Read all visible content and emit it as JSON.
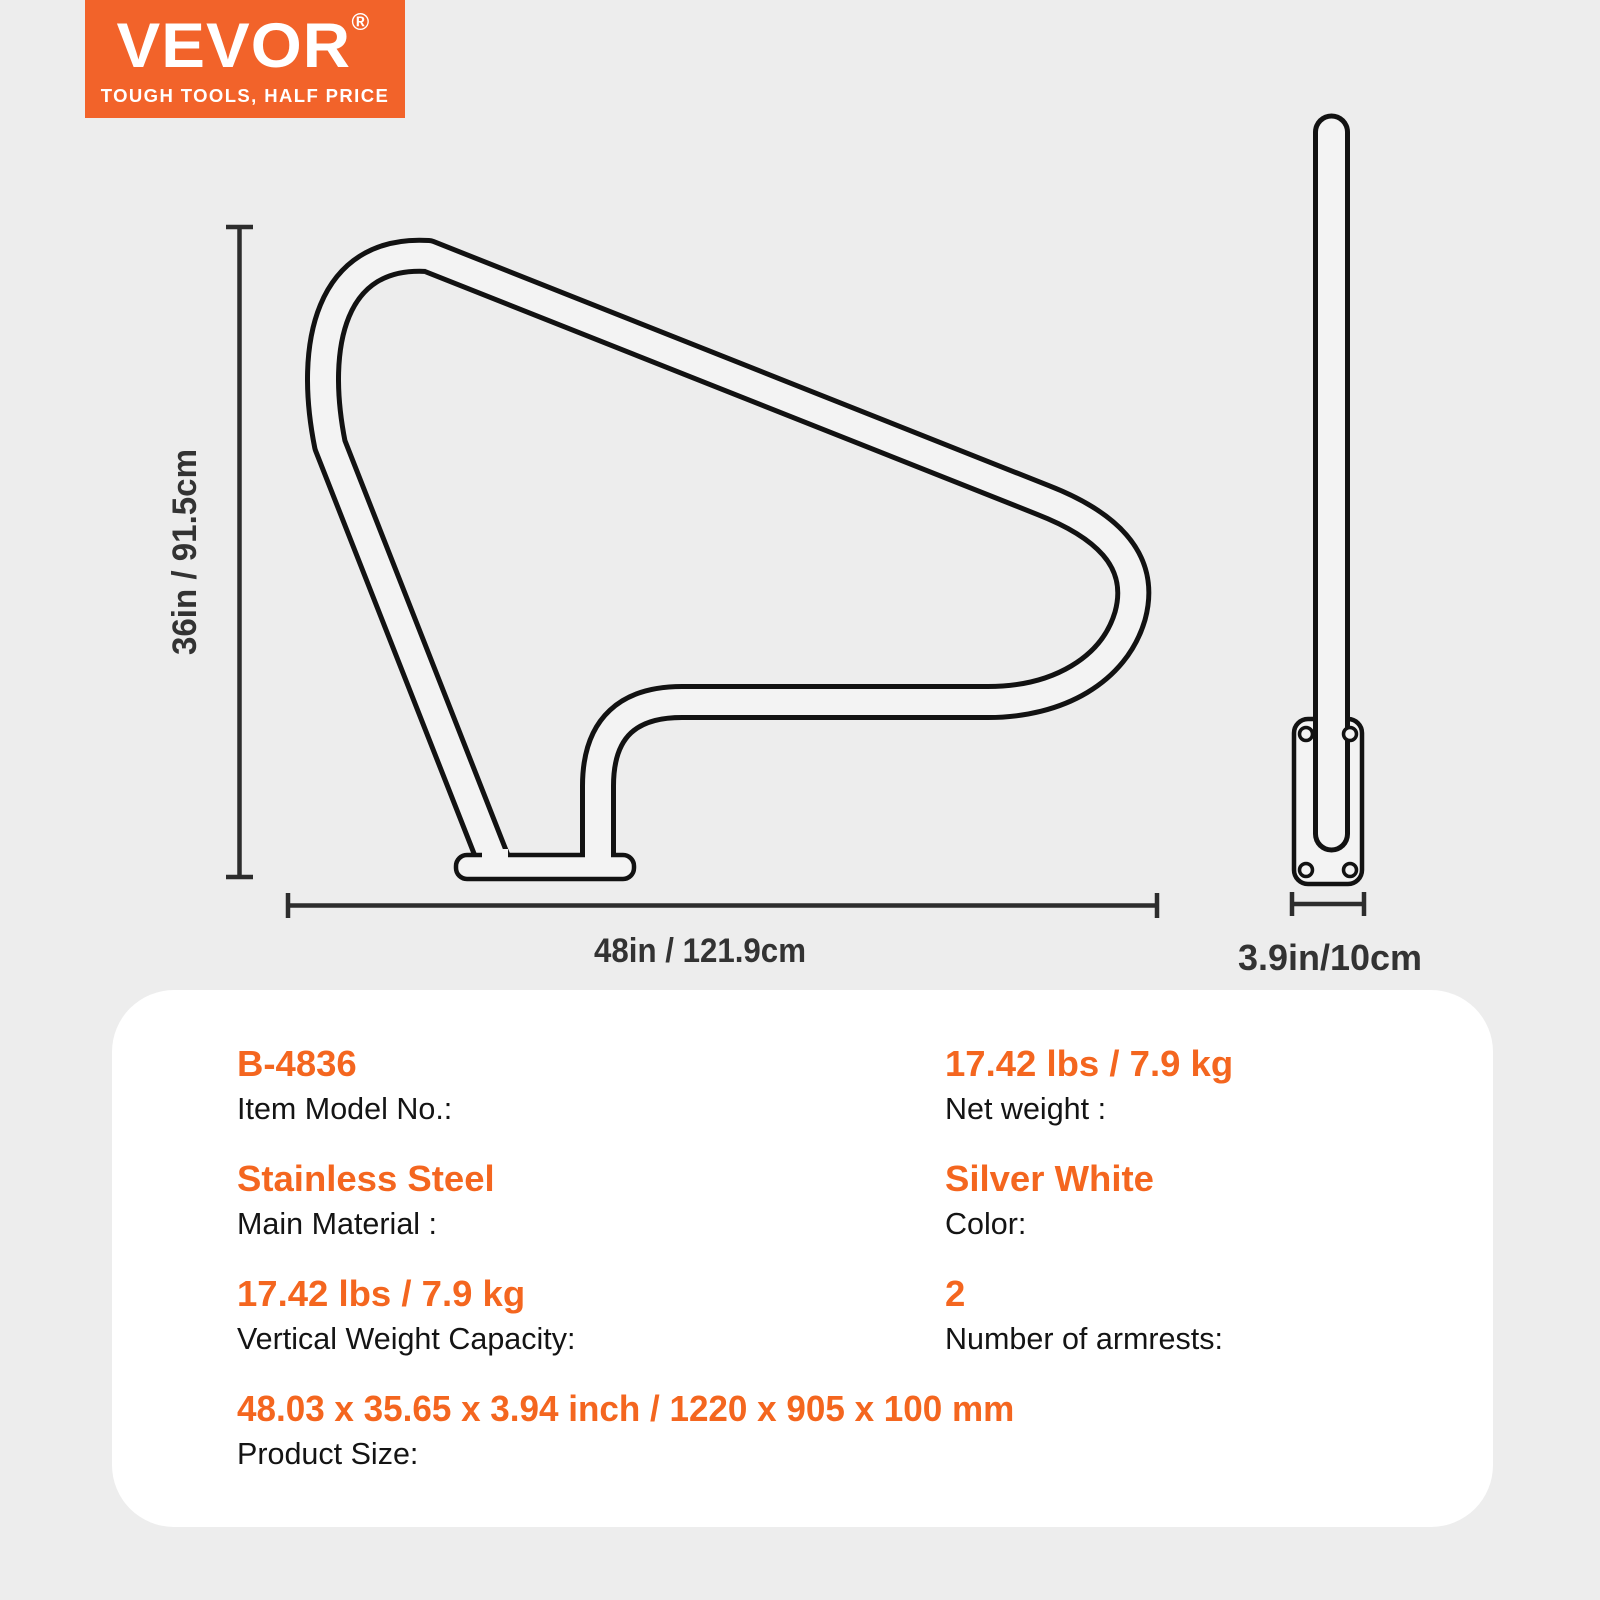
{
  "logo": {
    "brand": "VEVOR",
    "registered": "®",
    "tagline": "TOUGH TOOLS, HALF PRICE"
  },
  "diagram": {
    "height_label": "36in / 91.5cm",
    "width_label": "48in / 121.9cm",
    "depth_label": "3.9in/10cm"
  },
  "specs": {
    "rows": [
      {
        "value": "B-4836",
        "label": "Item Model No.:"
      },
      {
        "value": "17.42 lbs / 7.9 kg",
        "label": "Net weight :"
      },
      {
        "value": "Stainless Steel",
        "label": "Main Material :"
      },
      {
        "value": "Silver White",
        "label": "Color:"
      },
      {
        "value": "17.42 lbs / 7.9 kg",
        "label": "Vertical Weight Capacity:"
      },
      {
        "value": "2",
        "label": "Number of armrests:"
      },
      {
        "value": "48.03 x 35.65 x 3.94 inch / 1220 x 905 x 100 mm",
        "label": "Product Size:"
      }
    ]
  },
  "colors": {
    "brand_orange": "#F2632A",
    "value_orange": "#F4661F",
    "page_bg": "#EDEDED",
    "card_bg": "#FFFFFF",
    "line_dark": "#2D2D2D",
    "tube_fill": "#F3F3F3",
    "tube_edge": "#121212"
  }
}
